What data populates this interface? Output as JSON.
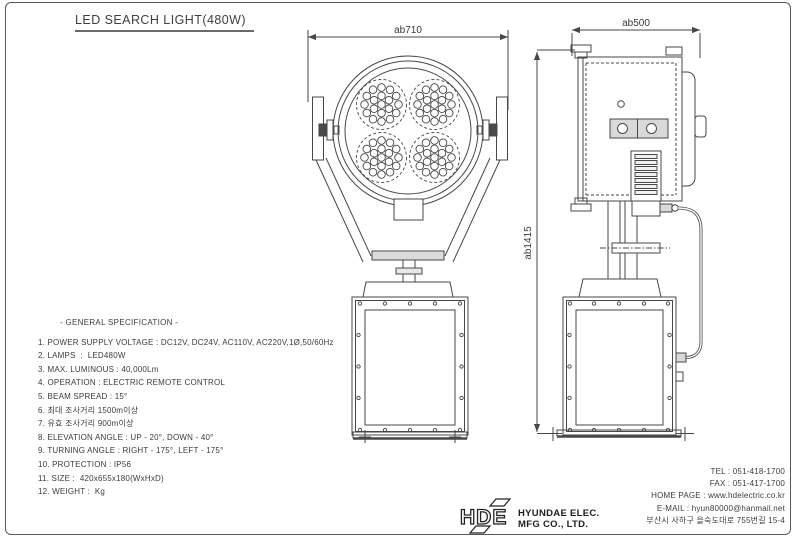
{
  "title": "LED SEARCH LIGHT(480W)",
  "dimensions": {
    "front_width": "ab710",
    "side_depth": "ab500",
    "side_height": "ab1415"
  },
  "spec": {
    "heading": "- GENERAL SPECIFICATION -",
    "items": [
      "1. POWER SUPPLY VOLTAGE : DC12V, DC24V, AC110V, AC220V,1Ø,50/60Hz",
      "2. LAMPS  :  LED480W",
      "3. MAX. LUMINOUS : 40,000Lm",
      "4. OPERATION : ELECTRIC REMOTE CONTROL",
      "5. BEAM SPREAD : 15°",
      "6. 최대 조사거리 1500m이상",
      "7. 유효 조사거리 900m이상",
      "8. ELEVATION ANGLE : UP - 20°, DOWN - 40°",
      "9. TURNING ANGLE : RIGHT - 175°, LEFT - 175°",
      "10. PROTECTION : IP56",
      "11. SIZE :  420x655x180(WxHxD)",
      "12. WEIGHT :  Kg"
    ]
  },
  "contact": {
    "tel": "TEL : 051-418-1700",
    "fax": "FAX : 051-417-1700",
    "homepage": "HOME PAGE : www.hdelectric.co.kr",
    "email": "E-MAIL : hyun80000@hanmail.net",
    "address": "부산시 사하구 을숙도대로 755번길 15-4"
  },
  "company": {
    "logo_text": "HDE",
    "name_line1": "HYUNDAE ELEC.",
    "name_line2": "MFG CO., LTD."
  },
  "colors": {
    "line": "#474747",
    "text": "#3a3a3a",
    "background": "#ffffff"
  }
}
